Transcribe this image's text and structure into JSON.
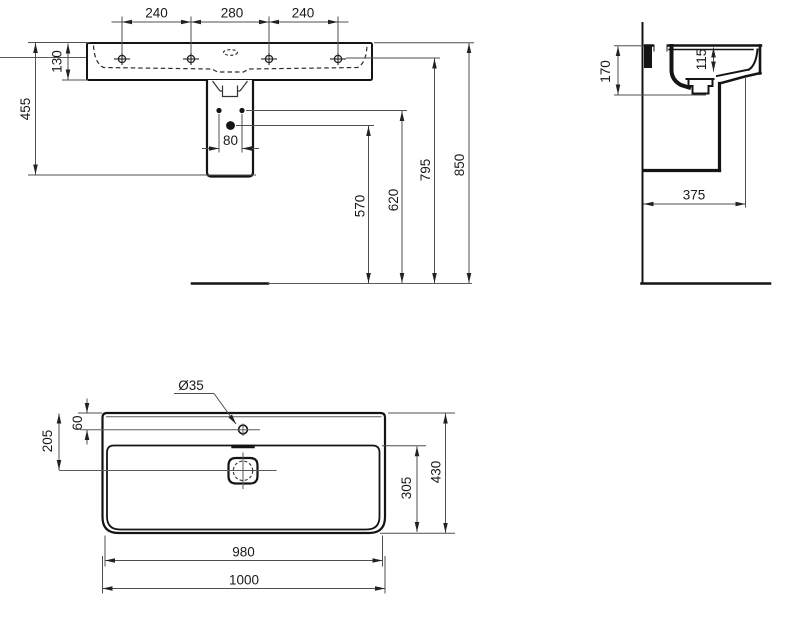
{
  "colors": {
    "ink": "#1a1a1a",
    "object_line": "#141414",
    "dim_line": "#4f4f4f",
    "background": "#ffffff"
  },
  "views": {
    "front": {
      "tap_hole_spacing_left": "240",
      "tap_hole_spacing_center": "280",
      "tap_hole_spacing_right": "240",
      "basin_height": "130",
      "basin_top_to_trap_bottom": "455",
      "fixing_hole_spacing": "80",
      "drain_dot_height": "570",
      "fixing_hole_height": "620",
      "tap_hole_height": "795",
      "total_height": "850"
    },
    "side": {
      "bowl_depth": "115",
      "profile_depth": "170",
      "projection": "375"
    },
    "plan": {
      "tap_hole_diameter": "Ø35",
      "tap_hole_offset": "60",
      "drain_offset": "205",
      "bowl_front_depth": "305",
      "total_depth": "430",
      "inner_width": "980",
      "total_width": "1000"
    }
  }
}
